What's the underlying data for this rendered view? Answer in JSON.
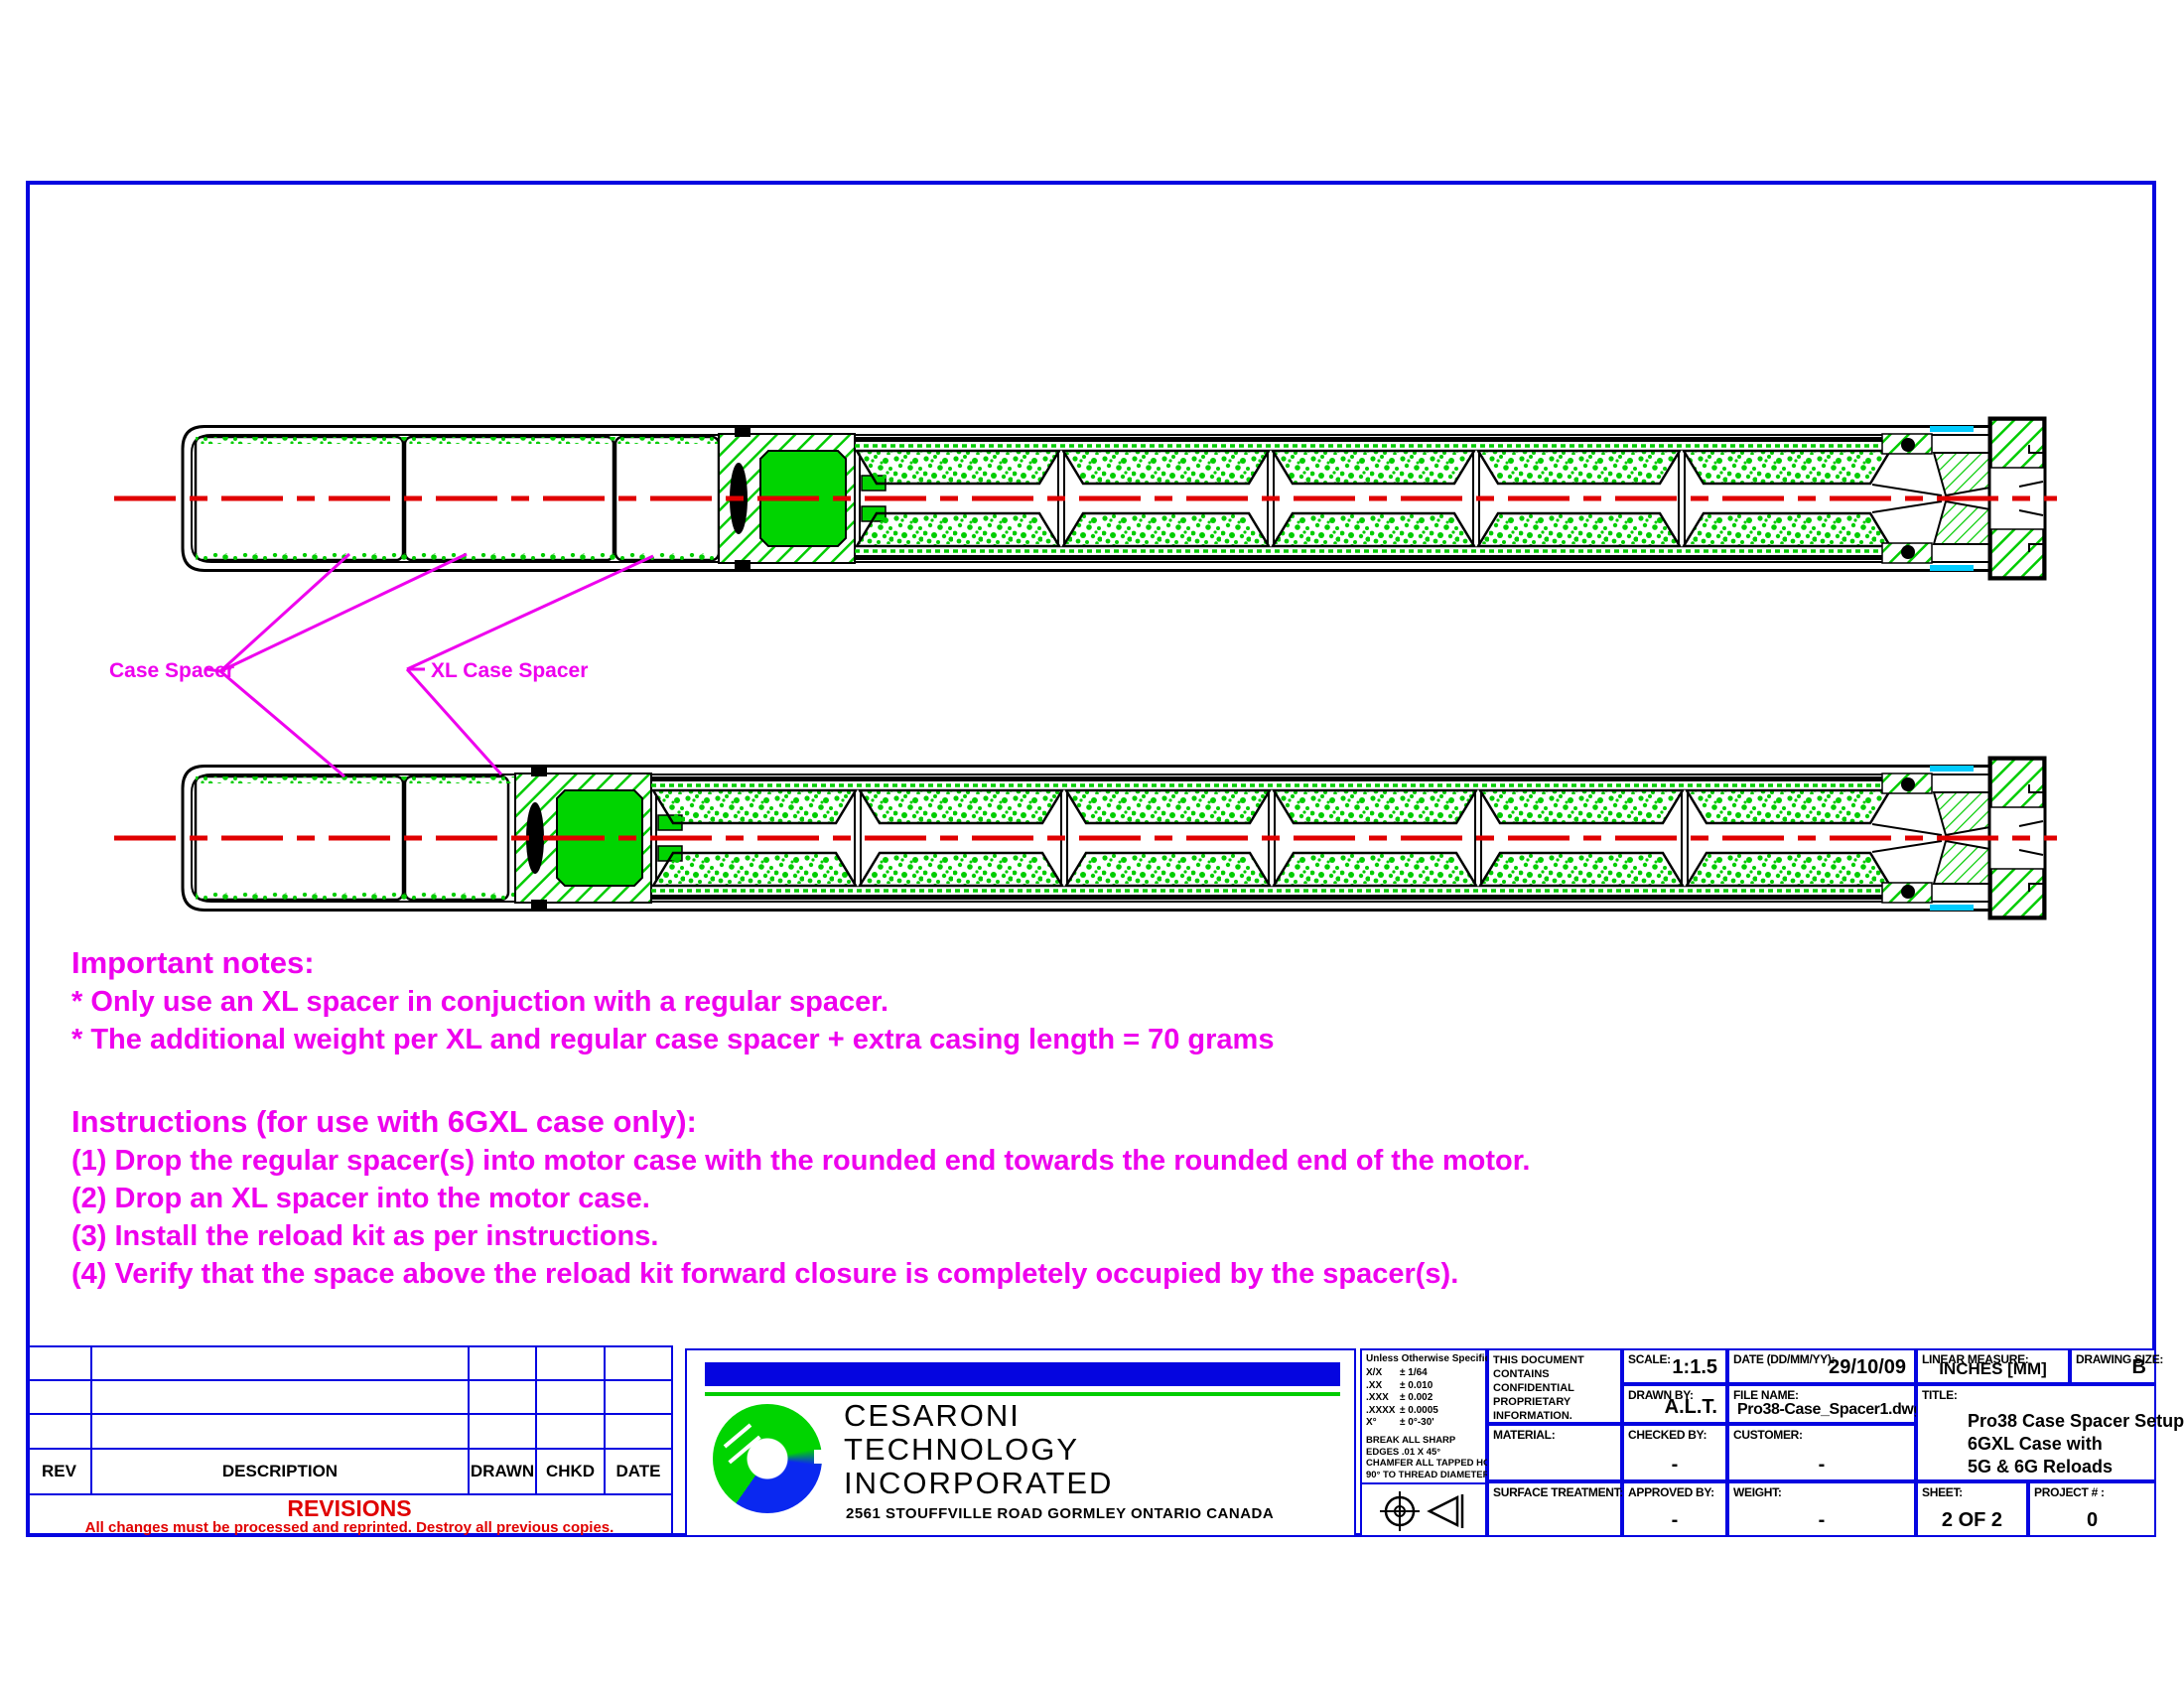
{
  "drawing_labels": {
    "case_spacer": "Case Spacer",
    "xl_case_spacer": "XL Case Spacer"
  },
  "notes": {
    "heading": "Important notes:",
    "lines": [
      "* Only use an XL spacer in conjuction with a regular spacer.",
      "* The additional weight per XL and regular case spacer + extra casing length = 70 grams"
    ],
    "instructions_heading": "Instructions (for use with 6GXL case only):",
    "instructions": [
      "(1) Drop the regular spacer(s) into motor case with the rounded end towards the rounded end of the motor.",
      "(2) Drop an XL spacer into the motor case.",
      "(3) Install the reload kit as per instructions.",
      "(4) Verify that the space above the reload kit forward closure is completely occupied by the spacer(s)."
    ]
  },
  "revisions": {
    "headers": [
      "REV",
      "DESCRIPTION",
      "DRAWN",
      "CHKD",
      "DATE"
    ],
    "title": "REVISIONS",
    "warning": "All changes must be processed and reprinted. Destroy all previous copies."
  },
  "company": {
    "line1": "CESARONI",
    "line2": "TECHNOLOGY",
    "line3": "INCORPORATED",
    "address": "2561 STOUFFVILLE ROAD GORMLEY ONTARIO CANADA"
  },
  "tolerances": {
    "heading": "Unless Otherwise Specified",
    "rows": [
      {
        "sym": "X/X",
        "val": "± 1/64"
      },
      {
        "sym": ".XX",
        "val": "± 0.010"
      },
      {
        "sym": ".XXX",
        "val": "± 0.002"
      },
      {
        "sym": ".XXXX",
        "val": "± 0.0005"
      },
      {
        "sym": "X°",
        "val": "± 0°-30'"
      }
    ],
    "notes": [
      "BREAK ALL SHARP",
      "EDGES .01 X 45°",
      "CHAMFER ALL TAPPED HOLES",
      "90° TO THREAD DIAMETER"
    ]
  },
  "tb": {
    "confidential": "THIS DOCUMENT CONTAINS CONFIDENTIAL PROPRIETARY INFORMATION. UNAUTHORIZED USE OR REPRODUCTION IS PROHIBITED.",
    "scale_label": "SCALE:",
    "scale": "1:1.5",
    "date_label": "DATE (DD/MM/YY):",
    "date": "29/10/09",
    "linear_label": "LINEAR MEASURE:",
    "linear": "INCHES [MM]",
    "size_label": "DRAWING SIZE:",
    "size": "B",
    "drawn_label": "DRAWN BY:",
    "drawn": "A.L.T.",
    "file_label": "FILE NAME:",
    "file": "Pro38-Case_Spacer1.dwg",
    "title_label": "TITLE:",
    "title_lines": [
      "Pro38 Case Spacer Setup",
      "6GXL Case with",
      "5G & 6G Reloads"
    ],
    "material_label": "MATERIAL:",
    "material": "",
    "checked_label": "CHECKED BY:",
    "checked": "-",
    "customer_label": "CUSTOMER:",
    "customer": "-",
    "surface_label": "SURFACE TREATMENT:",
    "surface": "",
    "approved_label": "APPROVED BY:",
    "approved": "-",
    "weight_label": "WEIGHT:",
    "weight": "-",
    "sheet_label": "SHEET:",
    "sheet": "2 OF 2",
    "project_label": "PROJECT # :",
    "project": "0"
  },
  "colors": {
    "frame_blue": "#0505e0",
    "magenta": "#ee00ee",
    "green": "#00cc00",
    "red": "#e00000",
    "cyan": "#00ccff"
  }
}
